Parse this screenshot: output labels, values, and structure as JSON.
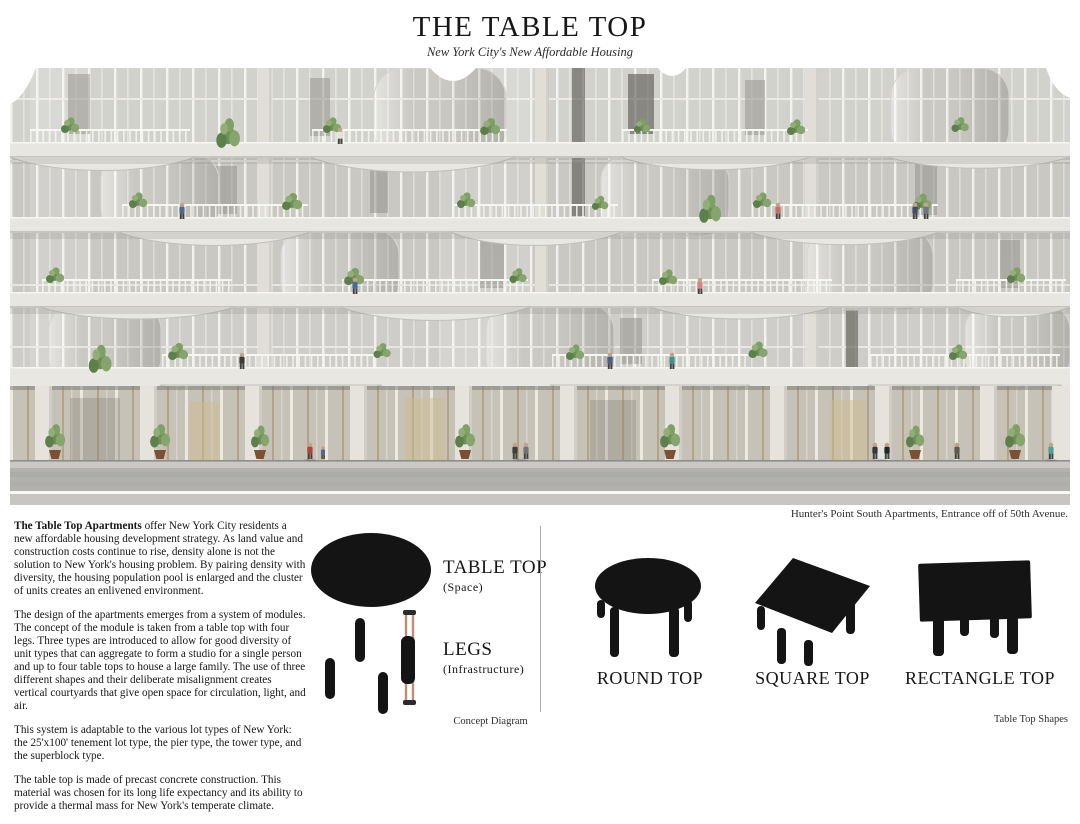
{
  "header": {
    "title": "THE TABLE TOP",
    "subtitle": "New York City's New Affordable Housing"
  },
  "rendering": {
    "caption": "Hunter's Point South Apartments, Entrance off of 50th Avenue."
  },
  "description": {
    "paragraphs": [
      {
        "lead": "The Table Top Apartments",
        "text": " offer New York City residents a new affordable housing development strategy.  As land value and construction costs continue to rise, density alone is not the solution to New York's housing problem.  By pairing density with diversity, the housing population pool is enlarged and the cluster of units creates an enlivened environment."
      },
      {
        "lead": "",
        "text": "The design of the apartments emerges from a system of modules.  The concept of the module is taken from a table top with four legs.  Three types are introduced to allow for good diversity of unit types that can aggregate to form a studio for a single person and up to four table tops to house a large family.  The use of three different shapes and their deliberate misalignment creates vertical courtyards that give open space for circulation, light, and air."
      },
      {
        "lead": "",
        "text": "This system is adaptable to the various lot types of New York: the 25'x100' tenement lot type, the pier type, the tower type, and the superblock type."
      },
      {
        "lead": "",
        "text": "The table top is made of precast concrete construction.  This material was chosen for its long life expectancy and its ability to provide a thermal mass for New York's temperate climate."
      }
    ]
  },
  "concept": {
    "table_top_label": "TABLE TOP",
    "table_top_sub": "(Space)",
    "legs_label": "LEGS",
    "legs_sub": "(Infrastructure)",
    "caption": "Concept Diagram"
  },
  "shapes": {
    "items": [
      {
        "label": "ROUND TOP"
      },
      {
        "label": "SQUARE TOP"
      },
      {
        "label": "RECTANGLE TOP"
      }
    ],
    "caption": "Table Top Shapes"
  },
  "palette": {
    "ink": "#1c1c1c",
    "copper": "#bd8d75",
    "concrete": "#e8e6e1",
    "glass": "#c9c8c3",
    "foliage": "#6f8f59",
    "road": "#b2b1ae"
  }
}
